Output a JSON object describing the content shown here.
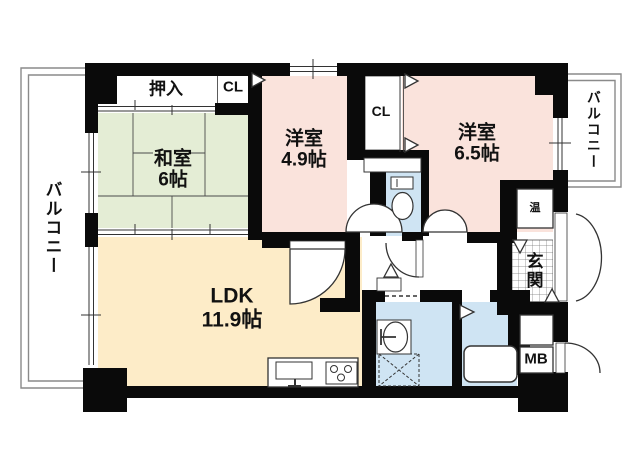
{
  "plan": {
    "rooms": [
      {
        "label": "和室",
        "area": "6帖"
      },
      {
        "label": "洋室",
        "area": "4.9帖"
      },
      {
        "label": "洋室",
        "area": "6.5帖"
      },
      {
        "label": "LDK",
        "area": "11.9帖"
      }
    ],
    "storage": {
      "oshiire": "押入",
      "cl_top": "CL",
      "cl_mid": "CL"
    },
    "balcony_left": "バルコニー",
    "balcony_right": "バルコニー",
    "entrance": "玄関",
    "water_heater": "温",
    "meter_box": "MB",
    "colors": {
      "tatami_room": "#e4edd5",
      "western_room": "#fae3dc",
      "ldk": "#fdecc8",
      "wet_area": "#cfe4f3",
      "wall": "#0a0a0a"
    }
  }
}
